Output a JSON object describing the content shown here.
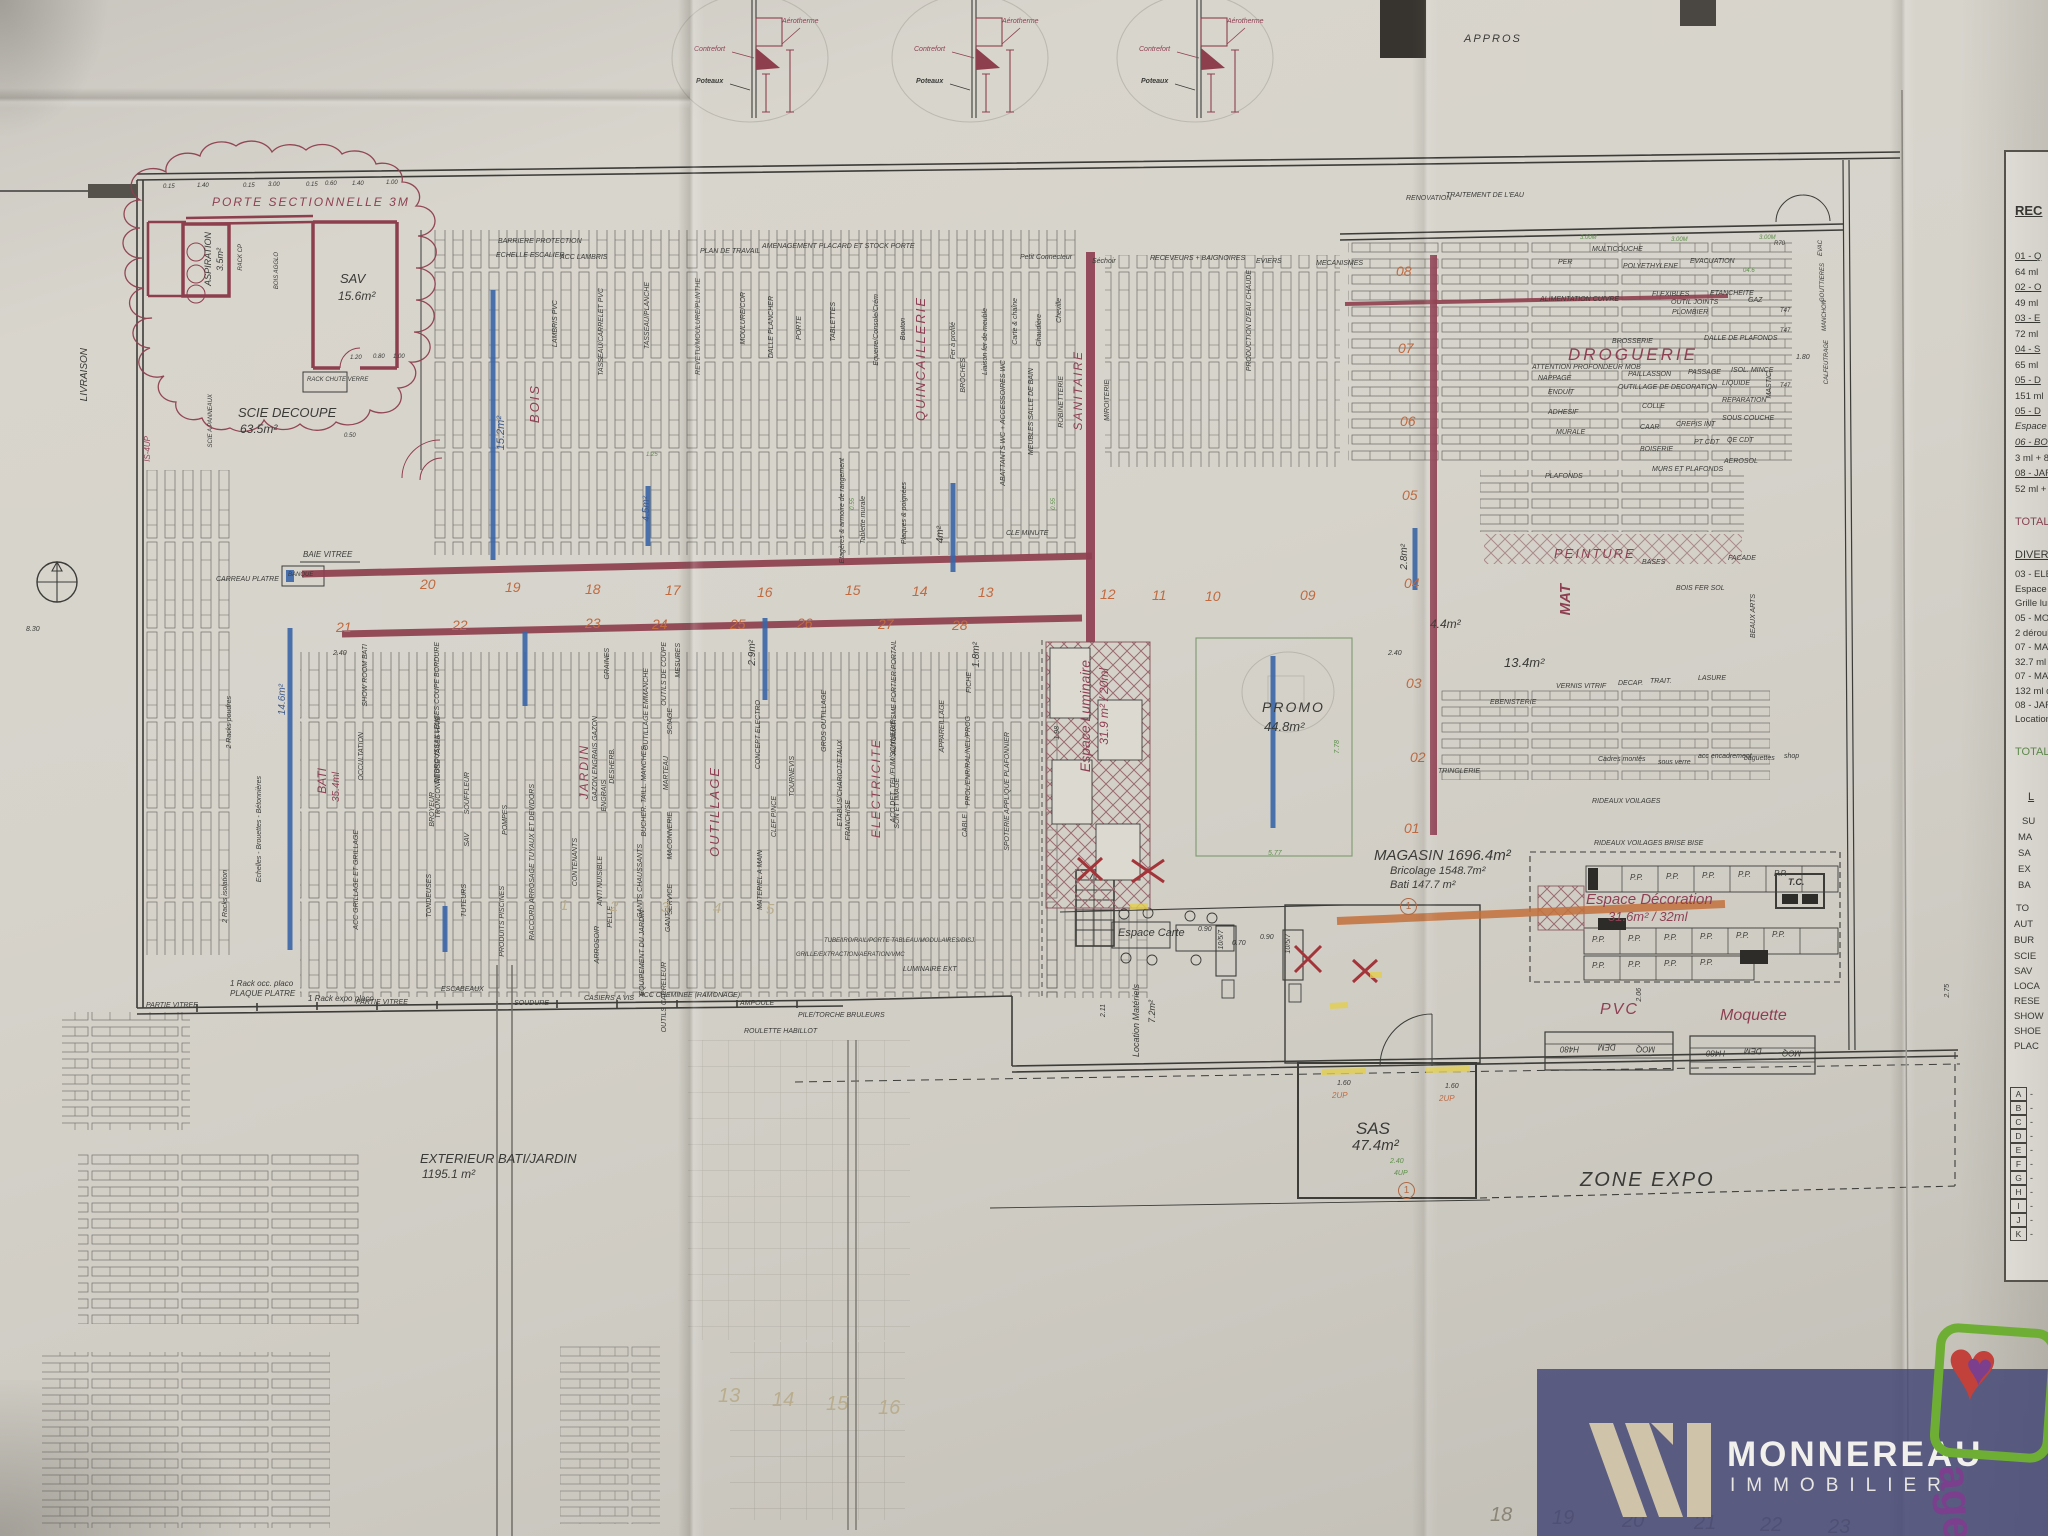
{
  "wm": {
    "brand": "MONNEREAU",
    "sub": "IMMOBILIER",
    "badge": "age"
  },
  "top": {
    "appros": "APPROS",
    "det": {
      "a": "Aérotherme",
      "c": "Contrefort",
      "p": "Poteaux",
      "d1": "2.33",
      "d2": "3.18"
    }
  },
  "rooms": {
    "porte": "PORTE SECTIONNELLE 3M",
    "aspiration": "ASPIRATION",
    "aspiration_area": "3.5m²",
    "sav": "SAV",
    "sav_area": "15.6m²",
    "scie": "SCIE DECOUPE",
    "scie_area": "63.5m²",
    "rack_cp": "RACK CP",
    "bois_agglo": "BOIS AGGLO",
    "rack_chute": "RACK CHUTE VERRE",
    "scie_panneaux": "SCIE A PANNEAUX",
    "livraison": "LIVRAISON",
    "baie": "BAIE VITREE",
    "carreau": "CARREAU PLATRE",
    "banque": "BANQUE",
    "partie": "PARTIE VITREE",
    "is4": "IS-4UP"
  },
  "dept": {
    "bois": "BOIS",
    "quinc": "QUINCAILLERIE",
    "sanit": "SANITAIRE",
    "drog": "DROGUERIE",
    "pein": "PEINTURE",
    "mat": "MAT",
    "elec": "ELECTRICITE",
    "outil": "OUTILLAGE",
    "jardin": "JARDIN",
    "bati": "BATI",
    "bati_ml": "35.4ml",
    "promo": "PROMO",
    "promo_area": "44.8m²",
    "lum": "Espace Luminaire",
    "lum_area": "31.9 m² / 20ml",
    "deco": "Espace Décoration",
    "deco_area": "31.6m² / 32ml",
    "carte": "Espace Carte",
    "loc": "Location Matériels",
    "loc_area": "7.2m²",
    "pvc": "PVC",
    "moq": "Moquette",
    "tc": "T.C.",
    "sas": "SAS",
    "sas_area": "47.4m²",
    "expo": "ZONE EXPO",
    "ext": "EXTERIEUR BATI/JARDIN",
    "ext_area": "1195.1 m²",
    "mag1": "MAGASIN 1696.4m²",
    "mag2": "Bricolage 1548.7m²",
    "mag3": "Bati 147.7 m²",
    "rideaux": "RIDEAUX VOILAGES BRISE BISE",
    "tringlerie": "TRINGLERIE",
    "rideaux2": "RIDEAUX VOILAGES"
  },
  "blue": {
    "a1": "15.2m²",
    "a2": "4.5m²",
    "a3": "4m²",
    "a4": "1.8m²",
    "a5": "2.8m²",
    "a6": "4.4m²",
    "a7": "13.4m²",
    "a8": "2.9m²",
    "a9": "14.6m²"
  },
  "aisles": {
    "r1": [
      "20",
      "19",
      "18",
      "17",
      "16",
      "15",
      "14",
      "13",
      "12",
      "11",
      "10",
      "09"
    ],
    "r2": [
      "21",
      "22",
      "23",
      "24",
      "25",
      "26",
      "27",
      "28"
    ],
    "col": [
      "08",
      "07",
      "06",
      "05",
      "04",
      "03",
      "02",
      "01"
    ]
  },
  "band": [
    "BARRIERE PROTECTION",
    "ECHELLE ESCALIER",
    "ACC LAMBRIS",
    "PLAN DE TRAVAIL",
    "AMENAGEMENT PLACARD ET STOCK PORTE",
    "Petit Connecteur",
    "Séchoir",
    "RECEVEURS + BAIGNOIRES",
    "EVIERS",
    "MECANISMES",
    "RENOVATION",
    "TRAITEMENT DE L'EAU",
    "PER",
    "MULTICOUCHE",
    "POLYETHYLENE",
    "EVACUATION"
  ],
  "su": [
    "LAMBRIS PVC",
    "TASSEAU/CARRELET PVC",
    "TASSEAU/PLANCHE",
    "REVETU/MOULURE/PLINTHE",
    "MOULURE/COR",
    "DALLE PLANCHER",
    "PORTE",
    "TABLETTES",
    "Etagères & armoire de rangement",
    "Tablette murale",
    "Plaques & poignées",
    "Equerre/Console/Crém",
    "Bouton",
    "Fer à profilé",
    "Liaison fer de meuble",
    "Carte & chaîne",
    "Chaudière",
    "Cheville",
    "CLE MINUTE",
    "BROCHES",
    "ABATTANTS WC + ACCESSOIRES WC",
    "MEUBLES SALLE DE BAIN",
    "ROBINETTERIE",
    "MIROITERIE",
    "PRODUCTION D'EAU CHAUDE"
  ],
  "sl": [
    "DEBROUSSAILLEUSES COUPE BORDURE",
    "TRONCONNEUSE TAILLE HAIE",
    "BROYEUR",
    "TONDEUSES",
    "SOUFFLEUR",
    "SAV",
    "TUTEURS",
    "POMPES",
    "PRODUITS PISCINES",
    "RACCORD ARROSAGE TUYAUX ET DEVIDORS",
    "CONTENANTS",
    "GRAINES",
    "GAZON ENGRAIS GAZON",
    "DESHERB.",
    "ENGRAIS",
    "ANTI NUISIBLE",
    "ARROSOIR",
    "PELLE",
    "OUTILS DE COUPE",
    "SCIAGE",
    "MESURES",
    "OUTILLAGE EMMANCHE",
    "BUCHER. TAILL. MANCHES",
    "MARTEAU",
    "MACONNERIE",
    "GANTS CHAUSSANTS",
    "SERVICE",
    "GANTS",
    "EQUIPEMENT DU JARDIN",
    "OUTILS CARRELEUR",
    "CONCEPT ELECTRO",
    "CLEF PINCE",
    "TOURNEVIS",
    "GROS OUTILLAGE",
    "ETABLIS/CHARIOT/ETAUX",
    "MATERIEL A MAIN",
    "FRANCHISE",
    "AUTOMATISME PORTIER PORTAIL",
    "ACC DET. TEL/FUM/SONNERIE",
    "SON ET IMAGE",
    "APPAREILLAGE",
    "FICHE",
    "PROL/ENR/RAL/NEL/PROG",
    "CABLE",
    "SPOTERIE APPLIQUE PLAFONNIER",
    "GRILLE/EXTRACTION/AERATION/VMC",
    "TUBE/IRO/RAIL/PORTE TABLEAU/MODULAIRES/DISJ.",
    "LUMINAIRE EXT",
    "AMPOULE",
    "SOUDURE",
    "ESCABEAUX",
    "CASIERS A VIS",
    "ACC CHEMINEE (RAMONAGE)",
    "PILE/TORCHE BRULEURS",
    "ROULETTE HABILLOT"
  ],
  "exg": [
    "2 Racks poudres",
    "2 Racks isolation",
    "1 Rack occ. placo",
    "PLAQUE PLATRE",
    "1 Rack expo placo",
    "Echelles - Brouettes - Bétonnières",
    "SHOW ROOM BATI",
    "OCCULTATION",
    "ACC GRILLAGE ET GRILLAGE"
  ],
  "dro": [
    "ALIMENTATION CUIVRE",
    "FLEXIBLES",
    "OUTIL JOINTS",
    "ETANCHEITE",
    "GAZ",
    "PLOMBIER",
    "BROSSERIE",
    "DALLE DE PLAFONDS",
    "ATTENTION PROFONDEUR MOB",
    "NAPPAGE",
    "PAILLASSON",
    "PASSAGE",
    "ISOL. MINCE",
    "ENDUIT",
    "OUTILLAGE DE DECORATION",
    "LIQUIDE",
    "ADHESIF",
    "COLLE",
    "REPARATION",
    "MURALE",
    "CAAR",
    "CREPIS INT",
    "SOUS COUCHE",
    "PT CDT",
    "QE CDT",
    "BOISERIE",
    "AEROSOL",
    "MASTIC",
    "PLAFONDS",
    "MURS ET PLAFONDS",
    "BASES",
    "FACADE",
    "BOIS FER SOL",
    "VERNIS VITRIF",
    "DECAP.",
    "TRAIT.",
    "LASURE",
    "EBENISTERIE",
    "Cadres montés",
    "sous verre",
    "acc encadrement",
    "baguettes",
    "shop",
    "RIDEAUX VOILAGES",
    "BEAUX ARTS",
    "EVAC",
    "GOUTTIERES",
    "MANCHON",
    "CALFEUTRAGE"
  ],
  "dims": {
    "d015": "0.15",
    "d140": "1.40",
    "d300": "3.00",
    "d060": "0.60",
    "d100": "1.00",
    "d120": "1.20",
    "d080": "0.80",
    "d050": "0.50",
    "d125": "1.25",
    "d055": "0.55",
    "d240": "2.40",
    "d160": "1.60",
    "d090": "0.90",
    "d070": "0.70",
    "d211": "2.11",
    "d577": "5.77",
    "d778": "7.78",
    "d198": "1.98",
    "d180": "1.80",
    "d206": "2.06",
    "d275": "2.75",
    "d830": "8.30",
    "d3m": "3.00M",
    "r70": "R70",
    "t47": "T47",
    "o46": "04.6",
    "up2": "2UP",
    "up4": "4UP"
  },
  "nums": {
    "front": [
      "1",
      "2",
      "3",
      "4",
      "5"
    ],
    "bottom": [
      "13",
      "14",
      "15",
      "16"
    ],
    "under": [
      "18",
      "19",
      "20",
      "21",
      "22",
      "23"
    ],
    "circ": "1",
    "lane": "10/5/7",
    "pp": "P.P.",
    "dem": "DEM",
    "moq": "MOQ",
    "h480": "H480"
  },
  "legend": {
    "title": "REC",
    "items": [
      "01 - Q",
      "64 ml",
      "02 - O",
      "49 ml",
      "03 - E",
      "72 ml",
      "04 - S",
      "65 ml",
      "05 - D",
      "151 ml",
      "05 - D",
      "Espace",
      "06 - BO",
      "3 ml + 8",
      "08 - JAR",
      "52 ml +"
    ],
    "total": "TOTAL",
    "divers_title": "DIVERS",
    "divers": [
      "03 - ELE",
      "Espace lu",
      "Grille lum",
      "05 - MOQ",
      "2 déroule",
      "07 - MATE",
      "32.7 ml de",
      "07 - MATE",
      "132 ml de",
      "08 - JARDI",
      "Location M"
    ],
    "total_po": "TOTAL PO",
    "table": [
      "L",
      "SU",
      "MA",
      "SA",
      "EX",
      "BA",
      "TO",
      "AUT",
      "BUR",
      "SCIE",
      "SAV",
      "LOCA",
      "RESE",
      "SHOW",
      "SHOE",
      "PLAC"
    ],
    "rows": [
      "A",
      "B",
      "C",
      "D",
      "E",
      "F",
      "G",
      "H",
      "I",
      "J",
      "K"
    ],
    "dash": "-"
  }
}
